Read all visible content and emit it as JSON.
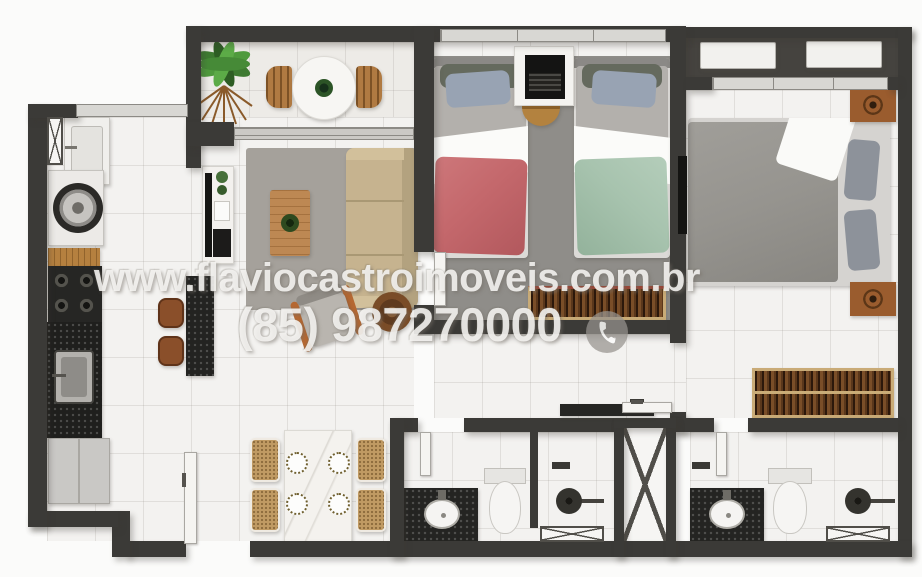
{
  "watermark": {
    "website": "www.flaviocastroimoveis.com.br",
    "phone": "(85) 987270000",
    "phone_icon": "phone-icon"
  },
  "palette": {
    "wall": "#3b3a37",
    "floor_tile": "#f3f2f0",
    "balcony_floor": "#edebe7",
    "technical_floor": "#45433f",
    "bedroom_carpet": "#8f8d89",
    "living_rug": "#a5a19b",
    "sofa_beige": "#c6b38f",
    "duvet_red": "#c4686c",
    "duvet_green": "#a7c3ae",
    "duvet_gray": "#96948f",
    "pillow_blue": "#98a3b3",
    "wood_light": "#b5803f",
    "wood_chair": "#b07a42",
    "wardrobe_wood": "#7a4e28",
    "counter_black": "#1f1f1d",
    "appliance_white": "#f2f1ee",
    "watermark_text": "#f6f5f3"
  },
  "rooms": [
    {
      "id": "balcony",
      "furniture": [
        "palm-plant",
        "round-table",
        "table-plant",
        "wood-chair",
        "wood-chair",
        "sliding-glass-door"
      ]
    },
    {
      "id": "service-area",
      "furniture": [
        "shaft-hatch",
        "laundry-tank",
        "washing-machine",
        "service-window"
      ]
    },
    {
      "id": "kitchen",
      "furniture": [
        "wood-counter",
        "cooktop",
        "sink-counter",
        "kitchen-sink",
        "refrigerator",
        "breakfast-bar",
        "bar-stool",
        "bar-stool",
        "entrance-door"
      ]
    },
    {
      "id": "living-room",
      "furniture": [
        "tv-rack",
        "tv-panel",
        "rug",
        "coffee-table",
        "sofa",
        "armchair",
        "side-table"
      ]
    },
    {
      "id": "dining-area",
      "furniture": [
        "dining-table",
        "plate",
        "plate",
        "plate",
        "plate",
        "rattan-chair",
        "rattan-chair",
        "rattan-chair",
        "rattan-chair"
      ]
    },
    {
      "id": "twin-bedroom",
      "furniture": [
        "window",
        "carpet",
        "single-bed-red",
        "single-bed-green",
        "desk",
        "laptop",
        "stool",
        "wardrobe",
        "door"
      ]
    },
    {
      "id": "master-bedroom",
      "furniture": [
        "window",
        "double-bed",
        "nightstand",
        "nightstand",
        "tv-panel",
        "wardrobe",
        "door"
      ]
    },
    {
      "id": "technical-area",
      "furniture": [
        "ac-condenser",
        "ac-condenser"
      ]
    },
    {
      "id": "hallway",
      "furniture": [
        "console-shelf"
      ]
    },
    {
      "id": "bathroom-1",
      "furniture": [
        "vanity-sink",
        "toilet",
        "shower-head",
        "shower-partition",
        "window-hatch",
        "door"
      ]
    },
    {
      "id": "elevator-shaft",
      "furniture": [
        "x-hatch"
      ]
    },
    {
      "id": "bathroom-2",
      "furniture": [
        "shower-valve",
        "vanity-sink",
        "toilet",
        "shower-head",
        "window-hatch",
        "door"
      ]
    }
  ]
}
